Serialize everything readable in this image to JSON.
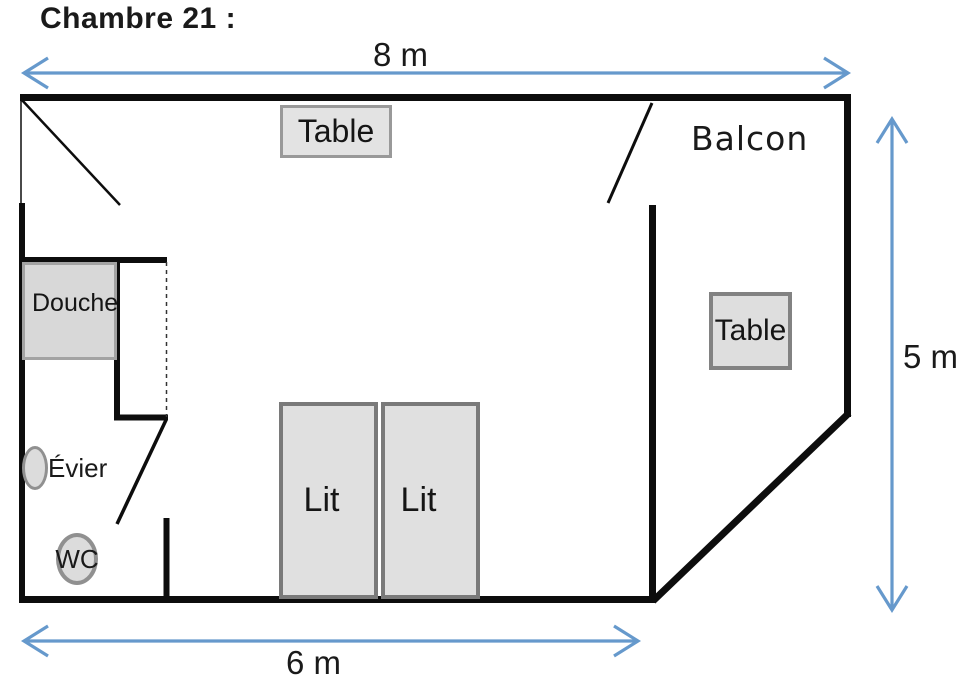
{
  "title": "Chambre 21 :",
  "dimensions": {
    "width_top": "8 m",
    "height_right": "5 m",
    "width_bottom": "6 m"
  },
  "rooms": {
    "balcony_label": "Balcon"
  },
  "furniture": {
    "table_top": "Table",
    "table_balcony": "Table",
    "shower": "Douche",
    "sink": "Évier",
    "toilet": "WC",
    "bed_left": "Lit",
    "bed_right": "Lit"
  },
  "colors": {
    "wall": "#0d0d0d",
    "arrow_blue": "#6699cc",
    "furniture_fill": "#dfdfdf",
    "furniture_border": "#828282",
    "text": "#1a1a1a"
  }
}
